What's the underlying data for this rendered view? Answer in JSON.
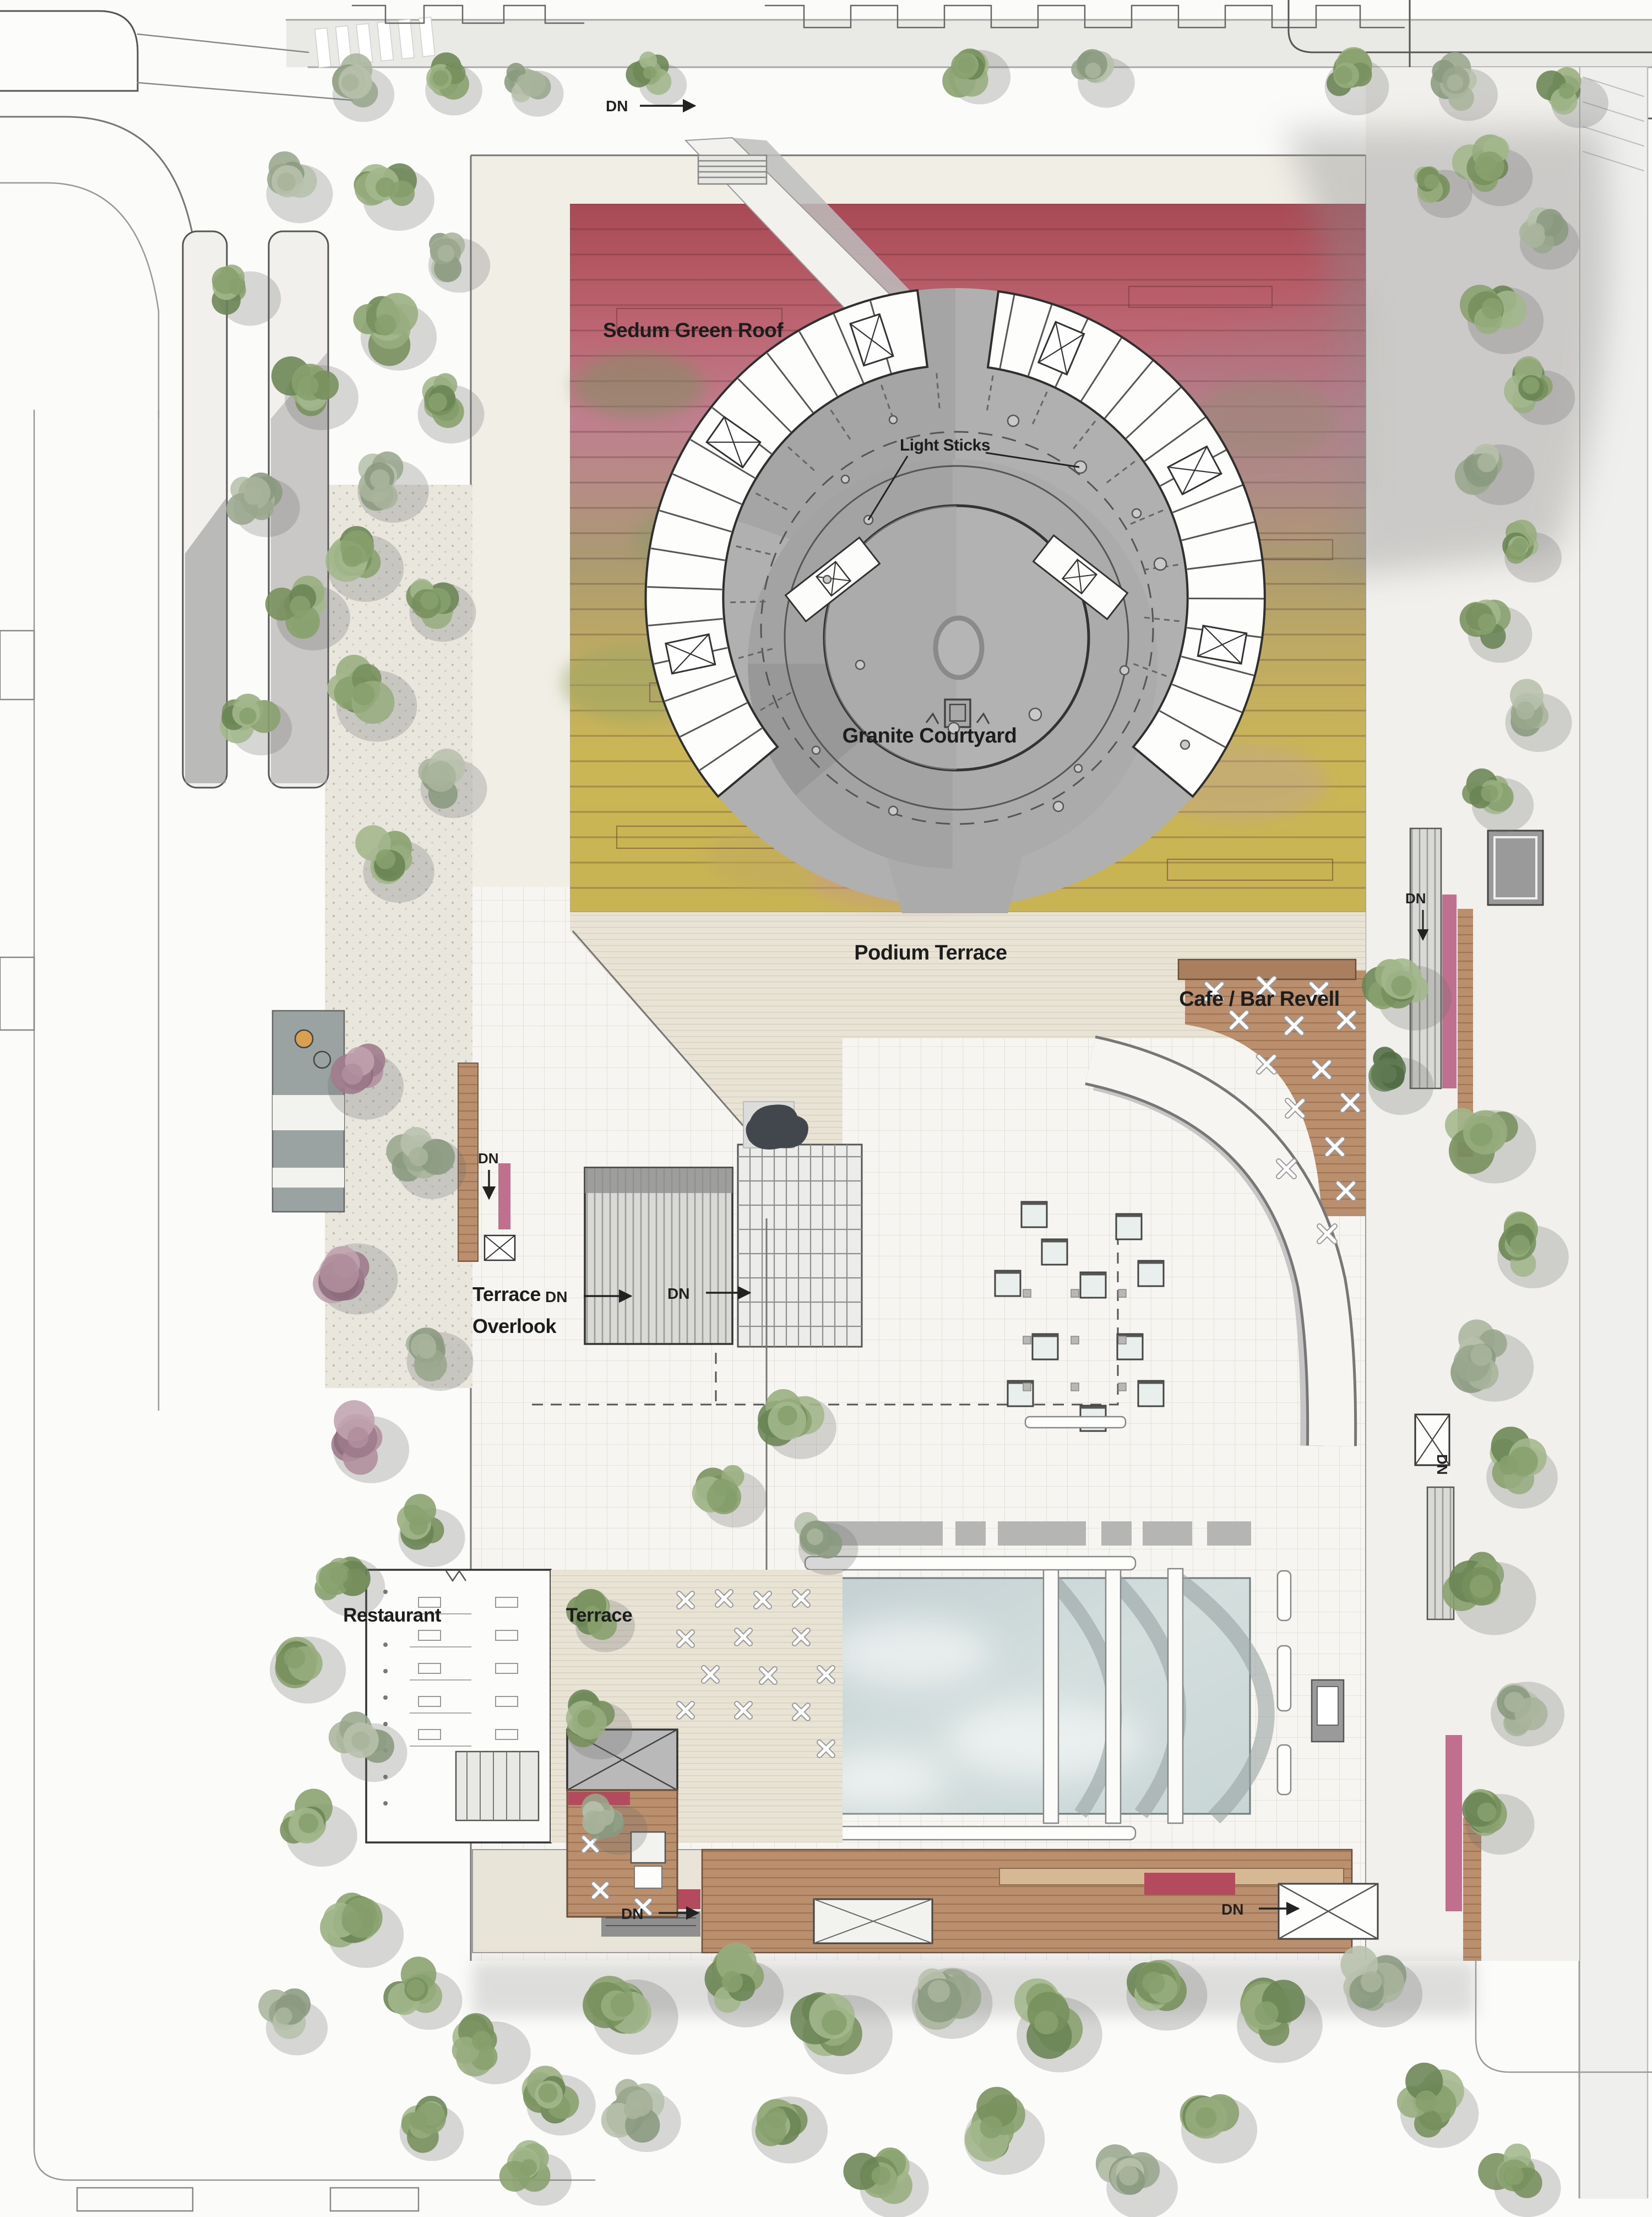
{
  "plan": {
    "labels": {
      "sedum_green_roof": "Sedum Green Roof",
      "light_sticks": "Light Sticks",
      "granite_courtyard": "Granite Courtyard",
      "podium_terrace": "Podium Terrace",
      "cafe_bar_revell": "Cafe / Bar Revell",
      "terrace_overlook_lines": [
        "Terrace",
        "Overlook"
      ],
      "restaurant": "Restaurant",
      "terrace": "Terrace",
      "down": "DN"
    },
    "colors": {
      "sedum_red": "#ad4f5c",
      "sedum_pink": "#c4798c",
      "sedum_yellow": "#cdb65a",
      "granite_gray": "#ababab",
      "wood_deck": "#b98f6e",
      "bench_brown": "#a97f5f",
      "pool_blue": "#ccd9da",
      "tree_green": "#87a06d",
      "shadow_gray": "#8e8e8e",
      "paving_light": "#f4f3ef"
    }
  }
}
